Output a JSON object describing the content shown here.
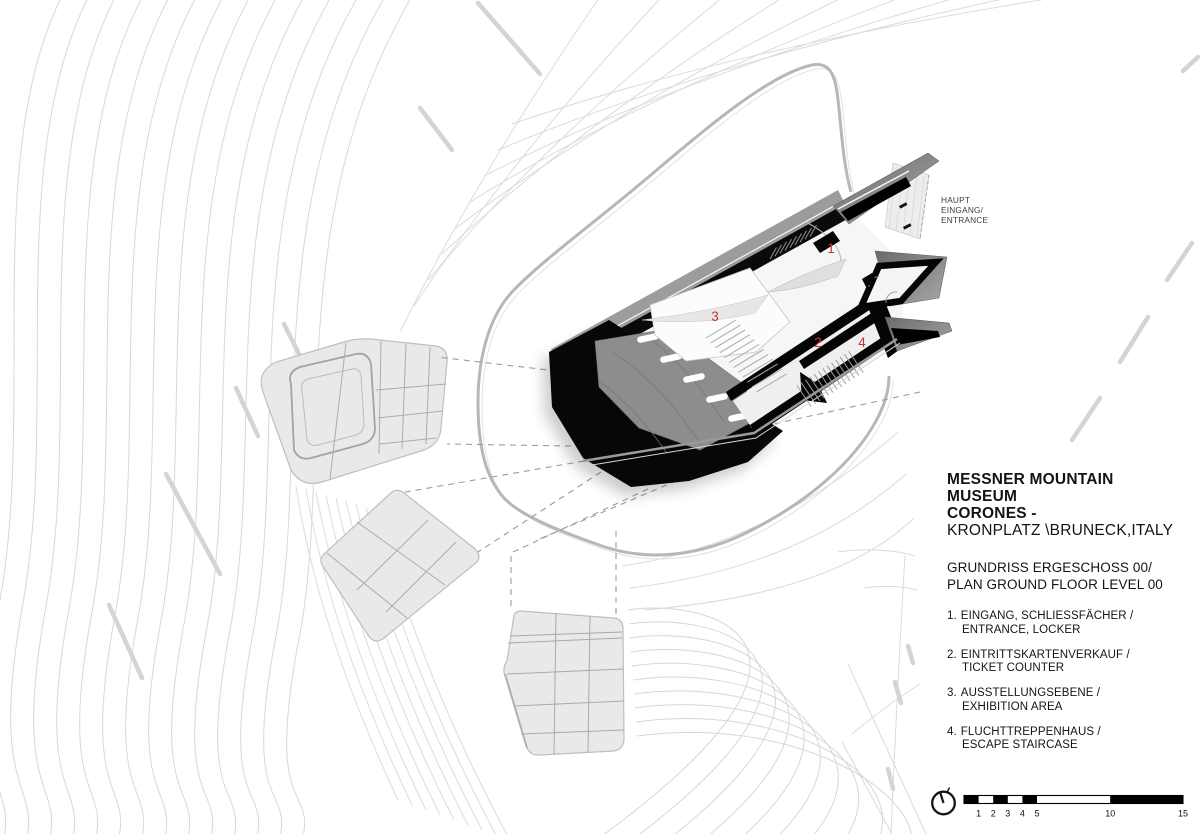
{
  "entrance_label": {
    "line1": "HAUPT",
    "line2": "EINGANG/",
    "line3": "ENTRANCE"
  },
  "room_markers": [
    {
      "num": "1"
    },
    {
      "num": "2"
    },
    {
      "num": "3"
    },
    {
      "num": "4"
    }
  ],
  "title_block": {
    "title_line1": "MESSNER MOUNTAIN MUSEUM",
    "title_line2": "CORONES -",
    "title_line3": "KRONPLATZ \\BRUNECK,ITALY",
    "subtitle_line1": "GRUNDRISS ERGESCHOSS 00/",
    "subtitle_line2": "PLAN GROUND FLOOR LEVEL 00",
    "legend": [
      {
        "num": "1.",
        "line1": "EINGANG, SCHLIESSFÄCHER /",
        "line2": "ENTRANCE, LOCKER"
      },
      {
        "num": "2.",
        "line1": "EINTRITTSKARTENVERKAUF /",
        "line2": "TICKET COUNTER"
      },
      {
        "num": "3.",
        "line1": "AUSSTELLUNGSEBENE /",
        "line2": "EXHIBITION AREA"
      },
      {
        "num": "4.",
        "line1": "FLUCHTTREPPENHAUS /",
        "line2": "ESCAPE STAIRCASE"
      }
    ]
  },
  "scalebar": {
    "ticks": [
      "1",
      "2",
      "3",
      "4",
      "5",
      "10",
      "15"
    ]
  },
  "colors": {
    "marker_red": "#cc3333",
    "ink": "#141414",
    "contour_gray": "#d8d8d8",
    "road_gray": "#b7b7b7",
    "roof_gray": "#8d8d8d",
    "building_black": "#070707",
    "structure_fill": "#e9e9e9"
  }
}
